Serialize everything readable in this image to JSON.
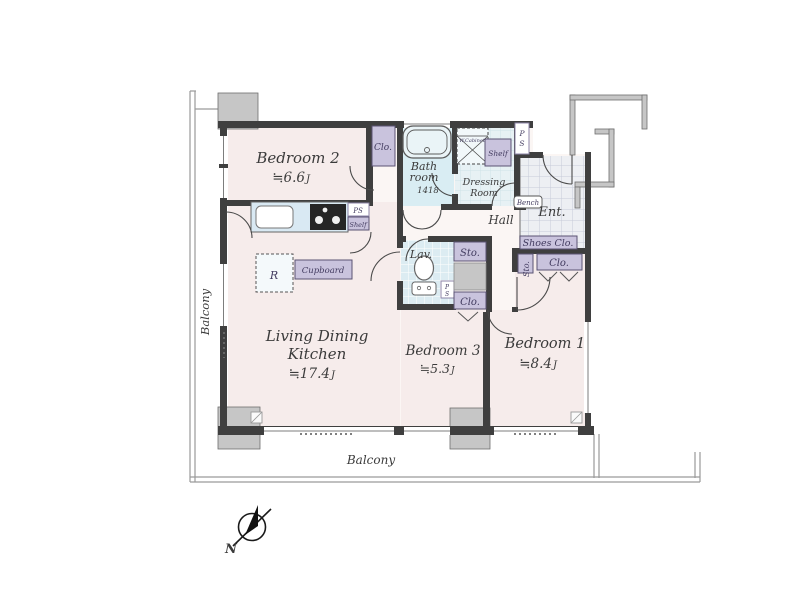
{
  "app": {
    "type": "apartment-floor-plan"
  },
  "colors": {
    "wall": "#3f3f3f",
    "room_floor": "#f6eceb",
    "hall_floor": "#fbf6f4",
    "bath_floor": "#d9edf3",
    "lav_floor": "#dcecf2",
    "dressing_floor": "#e7f1f4",
    "entrance_floor": "#edeff3",
    "closet_purple": "#c9c3dd",
    "counter_blue": "#d9e9f3",
    "pillar_gray": "#c6c6c6"
  },
  "rooms": {
    "bedroom2": {
      "name": "Bedroom 2",
      "size": "≒6.6",
      "unit": "J"
    },
    "bedroom1": {
      "name": "Bedroom 1",
      "size": "≒8.4",
      "unit": "J"
    },
    "bedroom3": {
      "name": "Bedroom 3",
      "size": "≒5.3",
      "unit": "J"
    },
    "ldk": {
      "name_line1": "Living Dining",
      "name_line2": "Kitchen",
      "size": "≒17.4",
      "unit": "J"
    },
    "bath": {
      "name_line1": "Bath",
      "name_line2": "room",
      "dimension": "1418"
    },
    "dressing": {
      "name_line1": "Dressing",
      "name_line2": "Room"
    },
    "hall": {
      "name": "Hall"
    },
    "entrance": {
      "name": "Ent."
    },
    "lavatory": {
      "name": "Lav."
    }
  },
  "fixtures": {
    "closet": "Clo.",
    "storage": "Sto.",
    "shoes_closet": "Shoes Clo.",
    "shelf": "Shelf",
    "pipe_space": "PS",
    "pipe_space_p": "P",
    "pipe_space_s": "S",
    "cupboard": "Cupboard",
    "refrigerator": "R",
    "bench": "Bench",
    "wall_cabinet": "W.Cabinet"
  },
  "balcony": {
    "left_label": "Balcony",
    "bottom_label": "Balcony"
  },
  "compass": {
    "north_label": "N"
  }
}
